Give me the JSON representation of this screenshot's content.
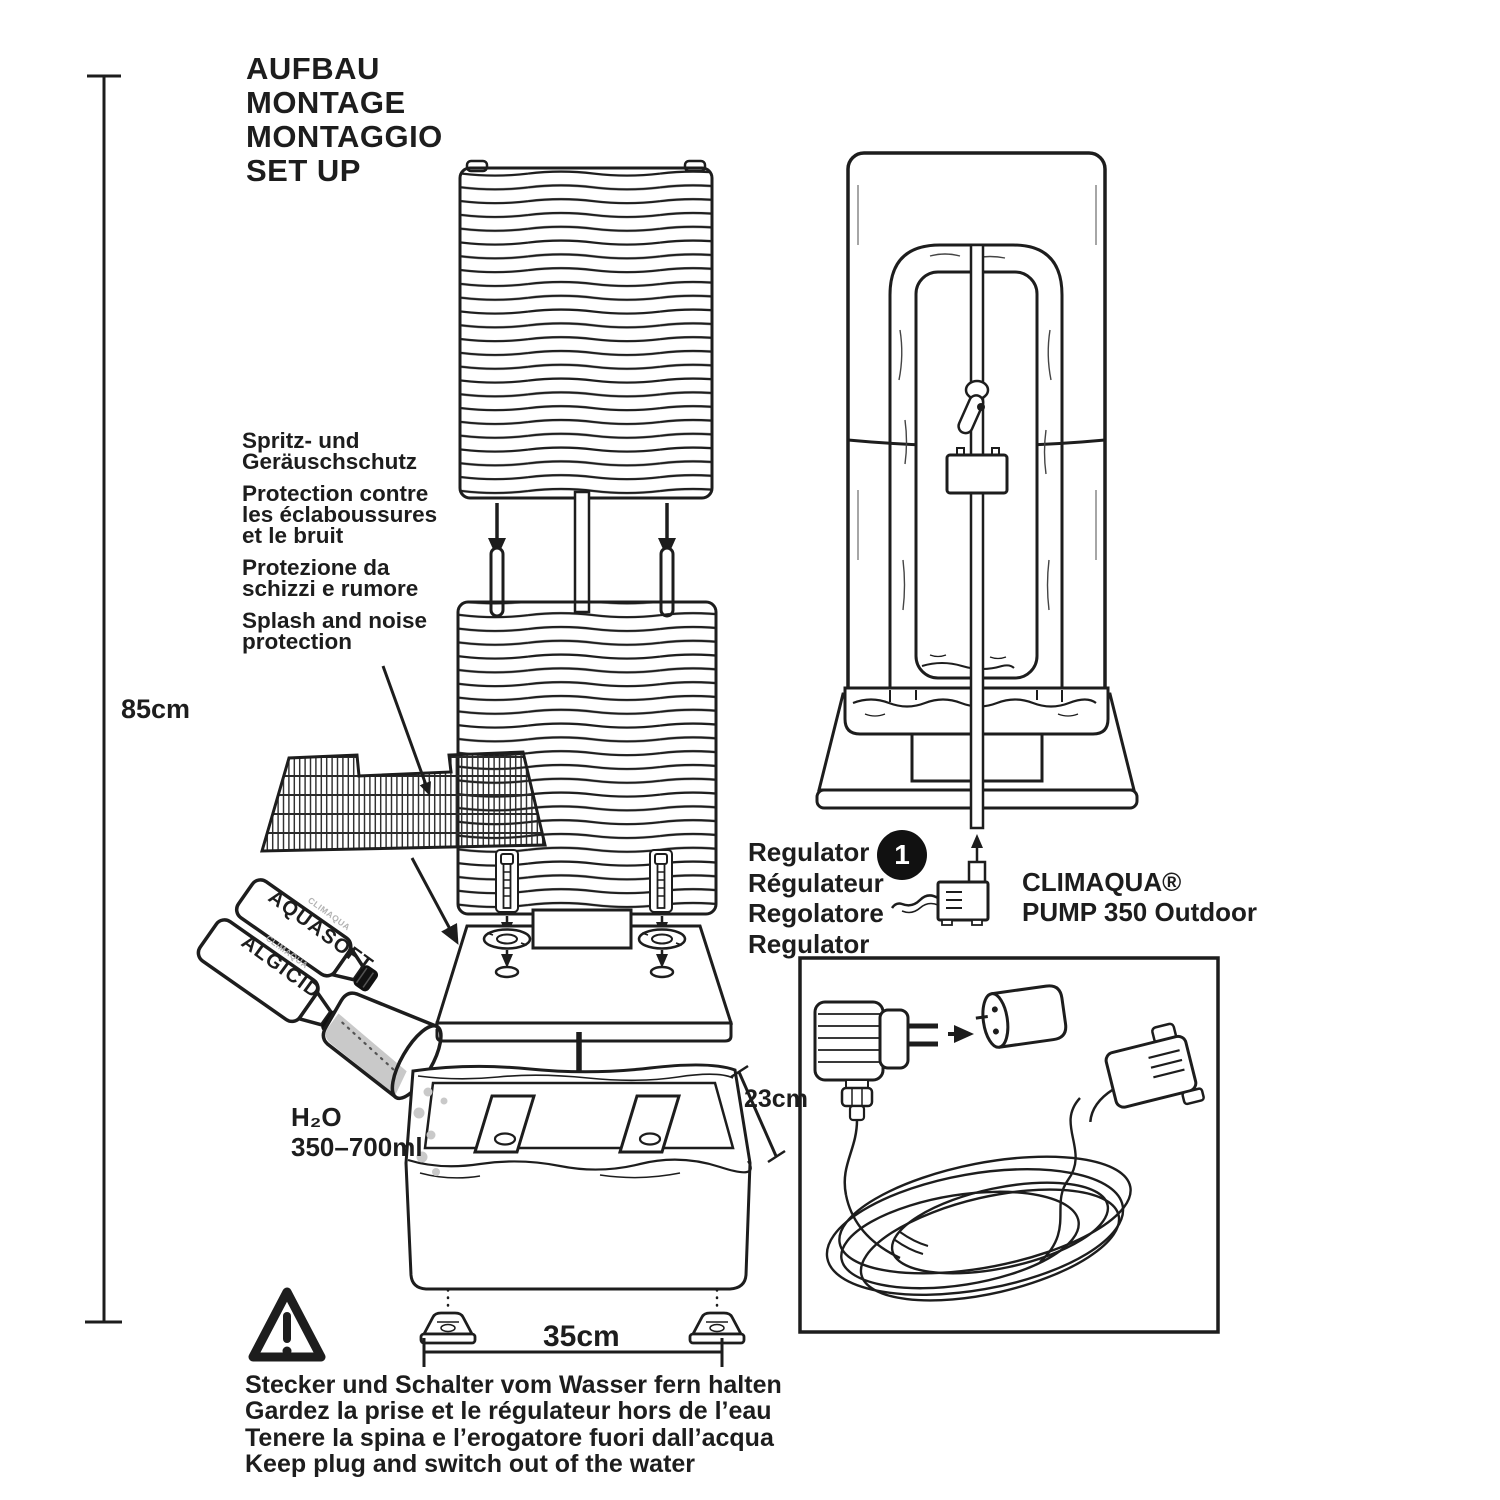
{
  "title_lines": [
    "AUFBAU",
    "MONTAGE",
    "MONTAGGIO",
    "SET UP"
  ],
  "dimensions": {
    "height": "85cm",
    "depth": "23cm",
    "width": "35cm"
  },
  "splash_protection": {
    "groups": [
      {
        "lines": [
          "Spritz- und",
          "Geräuschschutz"
        ]
      },
      {
        "lines": [
          "Protection contre",
          "les éclaboussures",
          "et le bruit"
        ]
      },
      {
        "lines": [
          "Protezione da",
          "schizzi e rumore"
        ]
      },
      {
        "lines": [
          "Splash and noise",
          "protection"
        ]
      }
    ]
  },
  "additives": {
    "brand": "CLIMAQUA",
    "bottle_1": "AQUASOFT",
    "bottle_2": "ALGICID",
    "water_formula": "H₂O",
    "water_amount": "350–700ml"
  },
  "regulator_lines": [
    "Regulator",
    "Régulateur",
    "Regolatore",
    "Regulator"
  ],
  "step_marker": "1",
  "pump_label": {
    "brand": "CLIMAQUA®",
    "model": "PUMP 350 Outdoor"
  },
  "warning_lines": [
    "Stecker und Schalter vom Wasser fern halten",
    "Gardez la prise et le régulateur hors de l’eau",
    "Tenere la spina e l’erogatore fuori dall’acqua",
    "Keep plug and switch out of the water"
  ],
  "colors": {
    "ink": "#1d1d1d",
    "background": "#ffffff",
    "water": "#c9c9c9"
  }
}
